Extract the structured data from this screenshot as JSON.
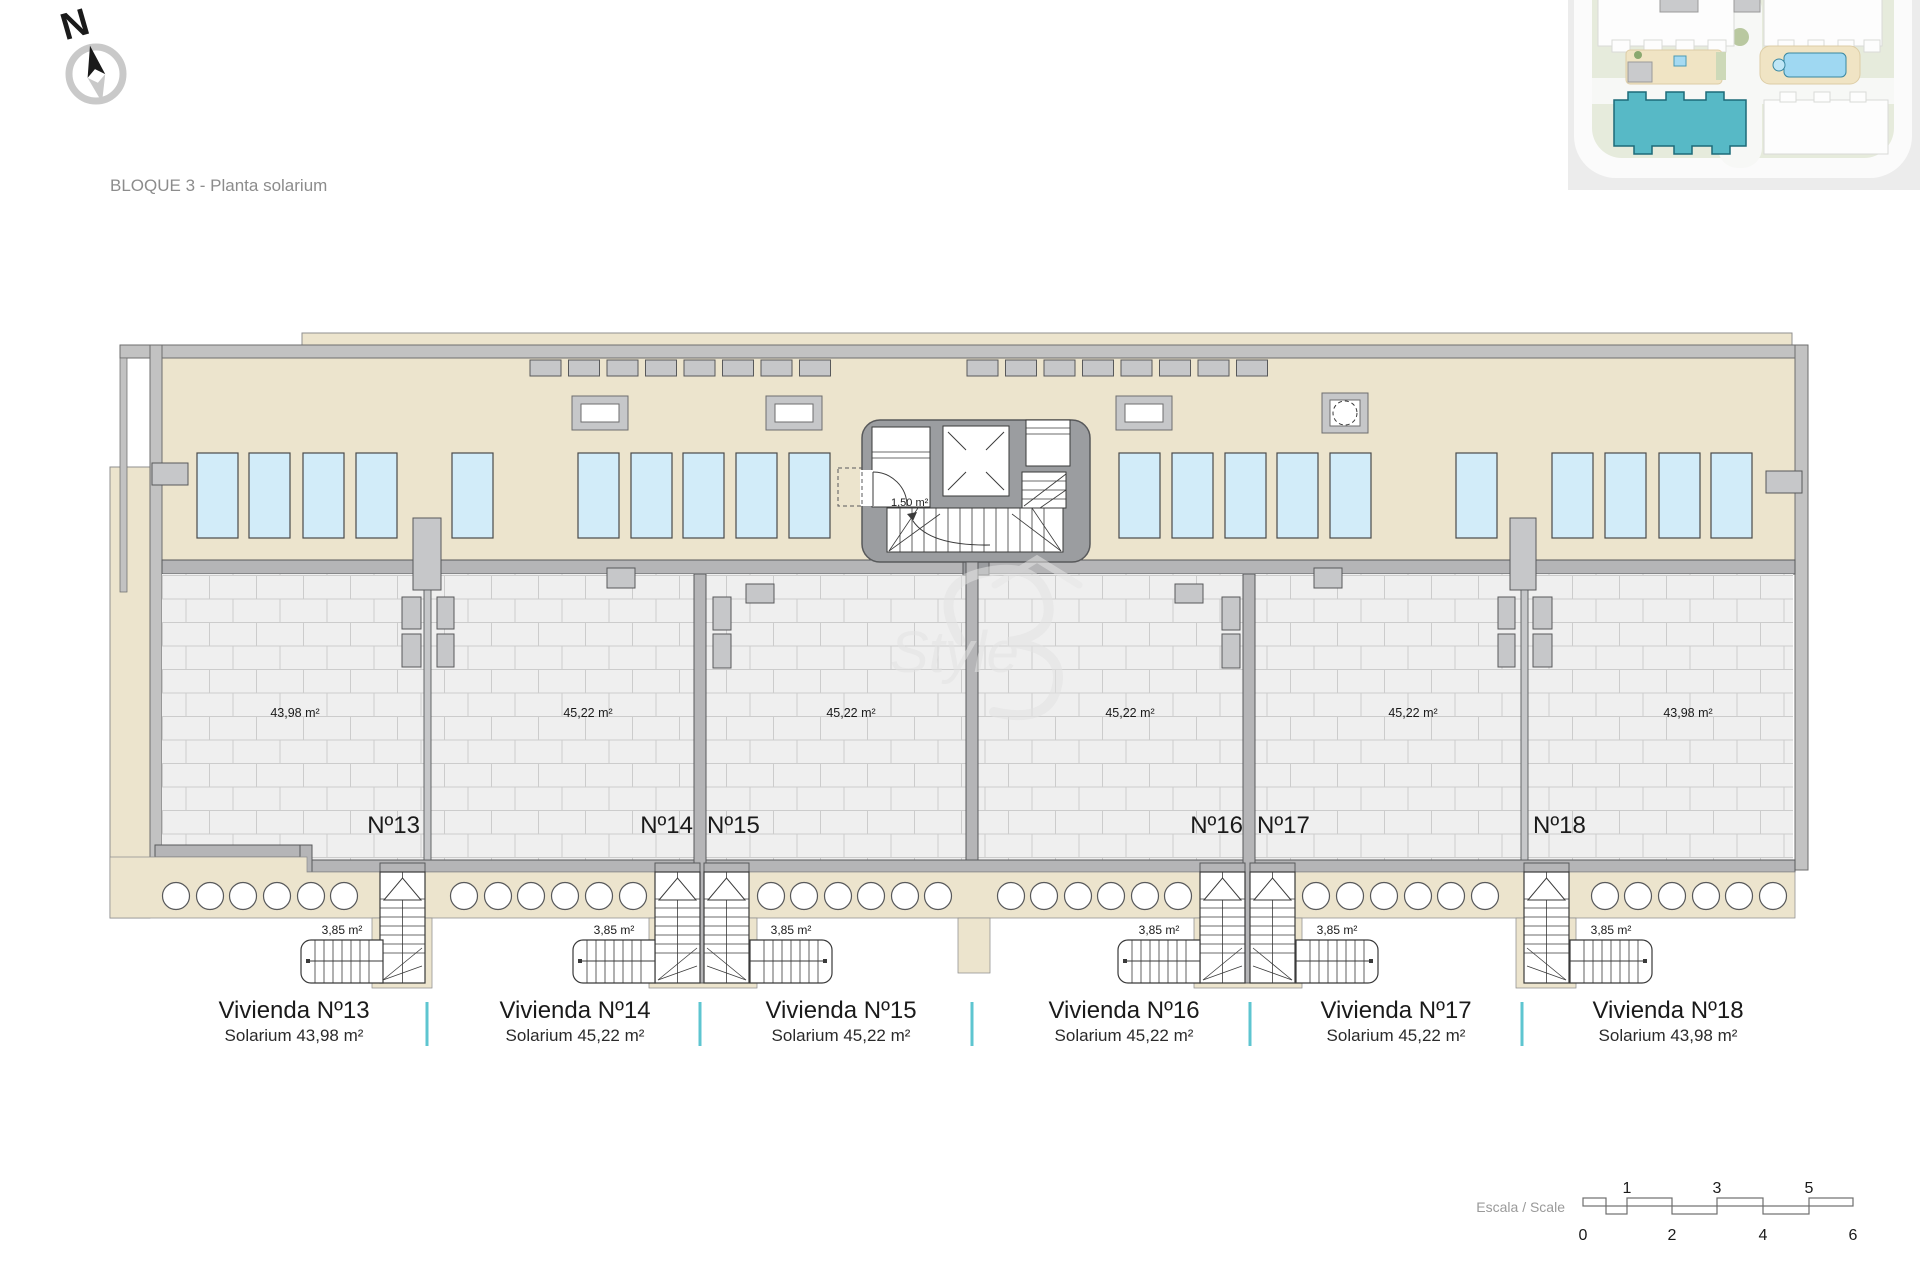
{
  "title": "BLOQUE 3 - Planta solarium",
  "compass": {
    "label": "N"
  },
  "watermark": {
    "label": "Style"
  },
  "core": {
    "wc_area_label": "1,50 m²"
  },
  "units": [
    {
      "id": 13,
      "number_label": "Nº13",
      "solarium_area_label": "43,98 m²",
      "stair_area_label": "3,85 m²",
      "vivienda_label": "Vivienda Nº13",
      "solarium_label": "Solarium 43,98 m²"
    },
    {
      "id": 14,
      "number_label": "Nº14",
      "solarium_area_label": "45,22 m²",
      "stair_area_label": "3,85 m²",
      "vivienda_label": "Vivienda Nº14",
      "solarium_label": "Solarium 45,22 m²"
    },
    {
      "id": 15,
      "number_label": "Nº15",
      "solarium_area_label": "45,22 m²",
      "stair_area_label": "3,85 m²",
      "vivienda_label": "Vivienda Nº15",
      "solarium_label": "Solarium 45,22 m²"
    },
    {
      "id": 16,
      "number_label": "Nº16",
      "solarium_area_label": "45,22 m²",
      "stair_area_label": "3,85 m²",
      "vivienda_label": "Vivienda Nº16",
      "solarium_label": "Solarium 45,22 m²"
    },
    {
      "id": 17,
      "number_label": "Nº17",
      "solarium_area_label": "45,22 m²",
      "stair_area_label": "3,85 m²",
      "vivienda_label": "Vivienda Nº17",
      "solarium_label": "Solarium 45,22 m²"
    },
    {
      "id": 18,
      "number_label": "Nº18",
      "solarium_area_label": "43,98 m²",
      "stair_area_label": "3,85 m²",
      "vivienda_label": "Vivienda Nº18",
      "solarium_label": "Solarium 43,98 m²"
    }
  ],
  "scale_bar": {
    "label": "Escala / Scale",
    "top_ticks": [
      "1",
      "3",
      "5"
    ],
    "bottom_ticks": [
      "0",
      "2",
      "4",
      "6"
    ]
  },
  "colors": {
    "beige": "#ece4cd",
    "wall": "#b5b5b7",
    "fixture": "#c6c7c9",
    "core": "#9b9da0",
    "paving": "#efefef",
    "paving_line": "#cccccc",
    "sunbed": "#d2ecf9",
    "outline": "#58595b",
    "teal_divider": "#5ec5d0",
    "site_highlight": "#57b9c6",
    "text_gray": "#8c8c8c"
  }
}
